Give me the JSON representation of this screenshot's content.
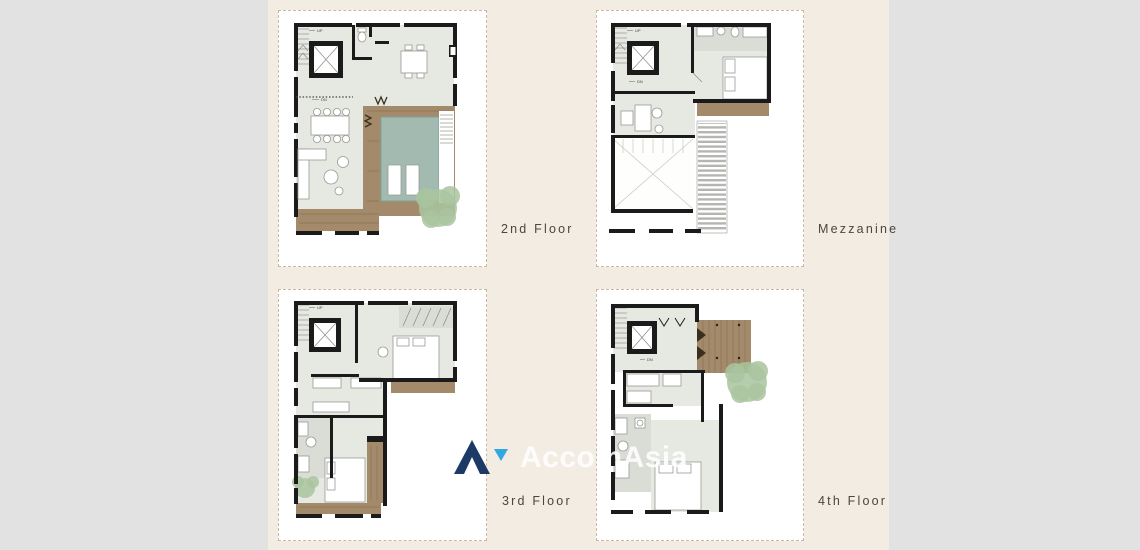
{
  "plans": [
    {
      "id": "2nd-floor",
      "label": "2nd Floor",
      "annotations": {
        "up": "UP",
        "dn": "DN"
      }
    },
    {
      "id": "mezzanine",
      "label": "Mezzanine",
      "annotations": {
        "up": "UP",
        "dn": "DN"
      }
    },
    {
      "id": "3rd-floor",
      "label": "3rd Floor",
      "annotations": {
        "up": "UP"
      }
    },
    {
      "id": "4th-floor",
      "label": "4th Floor",
      "annotations": {
        "dn": "DN"
      }
    }
  ],
  "watermark": {
    "brand": "AccomAsia"
  },
  "palette": {
    "background": "#f2ece3",
    "side_panel": "#e2e2e2",
    "card_background": "#ffffff",
    "card_border": "#ccb89e",
    "label_color": "#4b463e",
    "wall": "#1b1b1b",
    "tile": "#e6e8e2",
    "tile_dark": "#dadcd6",
    "deck": "#a28a6a",
    "deck_dark": "#8a7355",
    "pool": "#a3bab1",
    "tree": "#a9c49f",
    "logo_navy": "#1d3a66",
    "logo_blue": "#2fa9e0",
    "watermark_text": "#ffffff"
  }
}
